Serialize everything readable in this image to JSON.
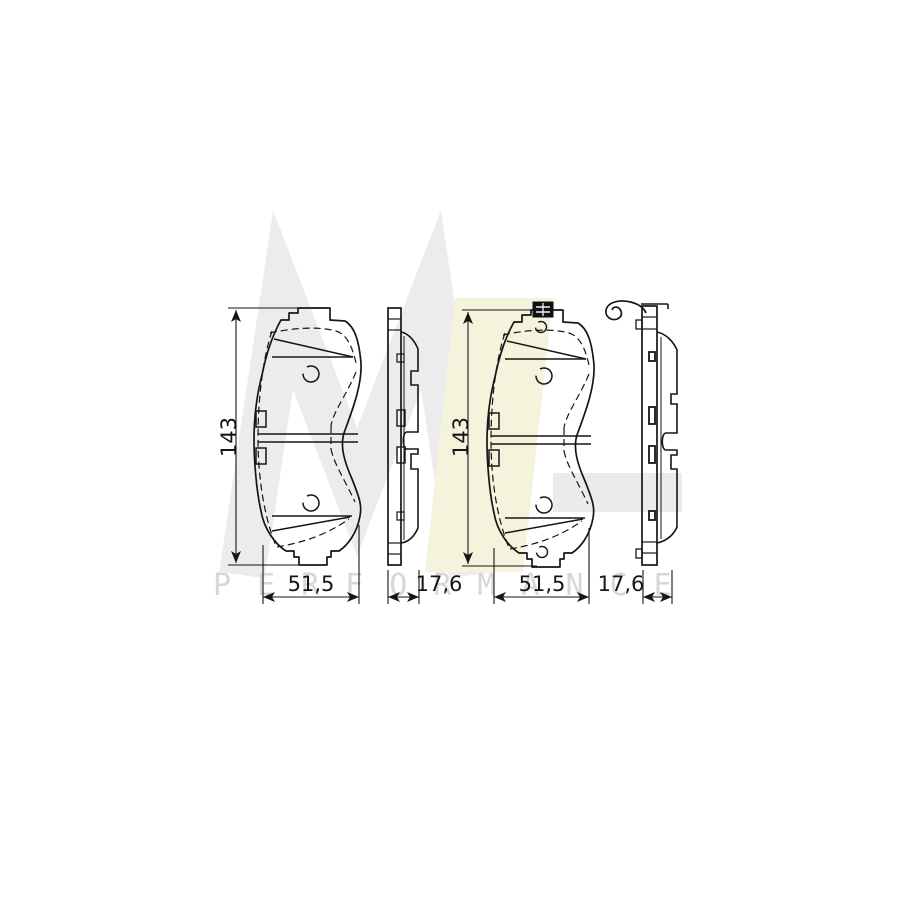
{
  "watermark": {
    "letter_m": "M",
    "letter_l": "L",
    "brand_text": "PERFORMANCE",
    "m_color": "#ececec",
    "l_color": "#f6f3dd",
    "band_color": "#ebebeb",
    "text_color": "#d7d7d7"
  },
  "drawing": {
    "line_color": "#161616",
    "views": [
      {
        "id": "pad-front-view-1",
        "height_label": "143",
        "width_label": "51,5"
      },
      {
        "id": "pad-side-view-1",
        "thickness_label": "17,6"
      },
      {
        "id": "pad-front-view-2",
        "height_label": "143",
        "width_label": "51,5"
      },
      {
        "id": "pad-side-view-2",
        "thickness_label": "17,6"
      }
    ]
  }
}
